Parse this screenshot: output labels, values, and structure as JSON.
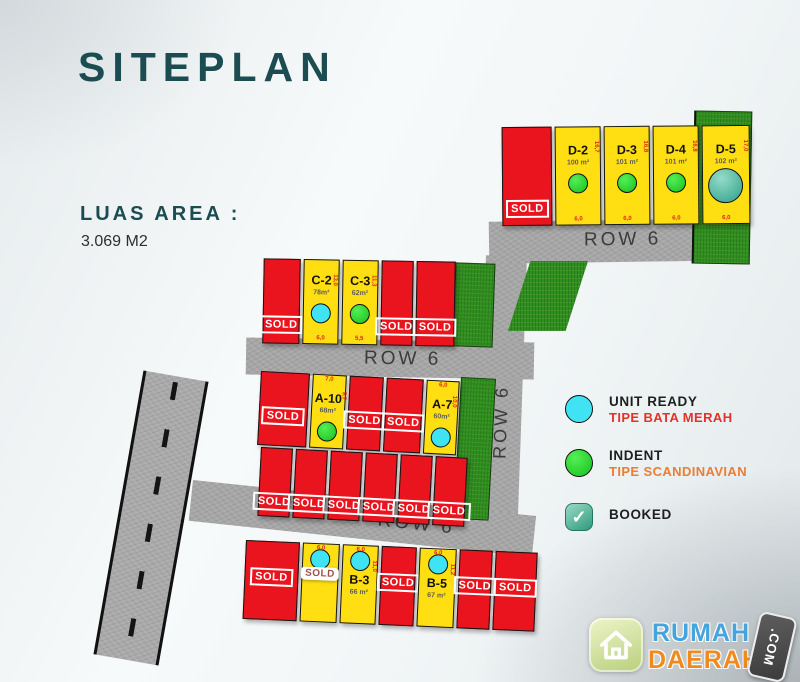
{
  "title": "SITEPLAN",
  "luas": {
    "label": "LUAS AREA :",
    "value": "3.069 M2"
  },
  "roads": {
    "row6": "ROW 6"
  },
  "sold_label": "SOLD",
  "legend": [
    {
      "label": "UNIT READY",
      "sub": "TIPE BATA MERAH",
      "marker": "ready"
    },
    {
      "label": "INDENT",
      "sub": "TIPE SCANDINAVIAN",
      "marker": "indent"
    },
    {
      "label": "BOOKED",
      "sub": "",
      "marker": "booked"
    }
  ],
  "legend_booked_check": "✓",
  "colors": {
    "accent_teal": "#1a4c51",
    "sold_red": "#e9141d",
    "available_yellow": "#ffdf12",
    "unit_ready_cyan": "#3fe3f4",
    "indent_green": "#16c01e",
    "booked_teal": "#2e9a7d",
    "tipe_bata_merah_red": "#e23329",
    "tipe_scandinavian_orange": "#ed7d31",
    "road_gray": "#a6a6a6",
    "grass_green": "#2f8f1d"
  },
  "blocks": {
    "d": [
      {
        "sold": true,
        "w": 1.1
      },
      {
        "id": "D-2",
        "area": "100 m²",
        "marker": "indent",
        "dim_side": "16,7",
        "dim_bottom": "6,0"
      },
      {
        "id": "D-3",
        "area": "101 m²",
        "marker": "indent",
        "dim_side": "16,8",
        "dim_bottom": "6,0"
      },
      {
        "id": "D-4",
        "area": "101 m²",
        "marker": "indent",
        "dim_side": "16,8",
        "dim_bottom": "6,0"
      },
      {
        "id": "D-5",
        "area": "102 m²",
        "marker": "ready-big",
        "dim_side": "17,0",
        "dim_bottom": "6,0",
        "w": 1.05
      }
    ],
    "c": [
      {
        "sold": true,
        "w": 1.05
      },
      {
        "id": "C-2",
        "area": "78m²",
        "marker": "ready",
        "dim_side": "13,0",
        "dim_bottom": "6,0"
      },
      {
        "id": "C-3",
        "area": "62m²",
        "marker": "indent",
        "dim_side": "11,3",
        "dim_bottom": "5,5"
      },
      {
        "sold": true,
        "w": 0.9
      },
      {
        "sold": true,
        "w": 1.1
      }
    ],
    "a_top": [
      {
        "sold": true,
        "w": 1.45
      },
      {
        "id": "A-10",
        "area": "68m²",
        "marker": "indent",
        "dim_top": "7,0",
        "dim_side": "9,7"
      },
      {
        "sold": true
      },
      {
        "sold": true,
        "w": 1.1
      },
      {
        "id": "A-7",
        "area": "60m²",
        "marker": "ready",
        "dim_top": "6,0",
        "dim_side": "10,0",
        "w": 0.95
      }
    ],
    "a_bottom": [
      {
        "sold": true
      },
      {
        "sold": true
      },
      {
        "sold": true
      },
      {
        "sold": true
      },
      {
        "sold": true
      },
      {
        "sold": true
      }
    ],
    "b": [
      {
        "sold": true,
        "w": 1.5
      },
      {
        "id": "B-2",
        "hide_id": true,
        "marker": "ready",
        "badge": "white",
        "dim_top": "6,0"
      },
      {
        "id": "B-3",
        "area": "66 m²",
        "marker": "ready",
        "dim_top": "6,0",
        "dim_side": "11,0"
      },
      {
        "sold": true,
        "w": 0.95
      },
      {
        "id": "B-5",
        "area": "67 m²",
        "marker": "ready",
        "dim_top": "6,0",
        "dim_side": "11,2"
      },
      {
        "sold": true,
        "w": 0.9
      },
      {
        "sold": true,
        "w": 1.15
      }
    ]
  },
  "logo": {
    "name_top": "RUMAH",
    "name_bottom": "DAERAH",
    "tag": ".COM"
  }
}
